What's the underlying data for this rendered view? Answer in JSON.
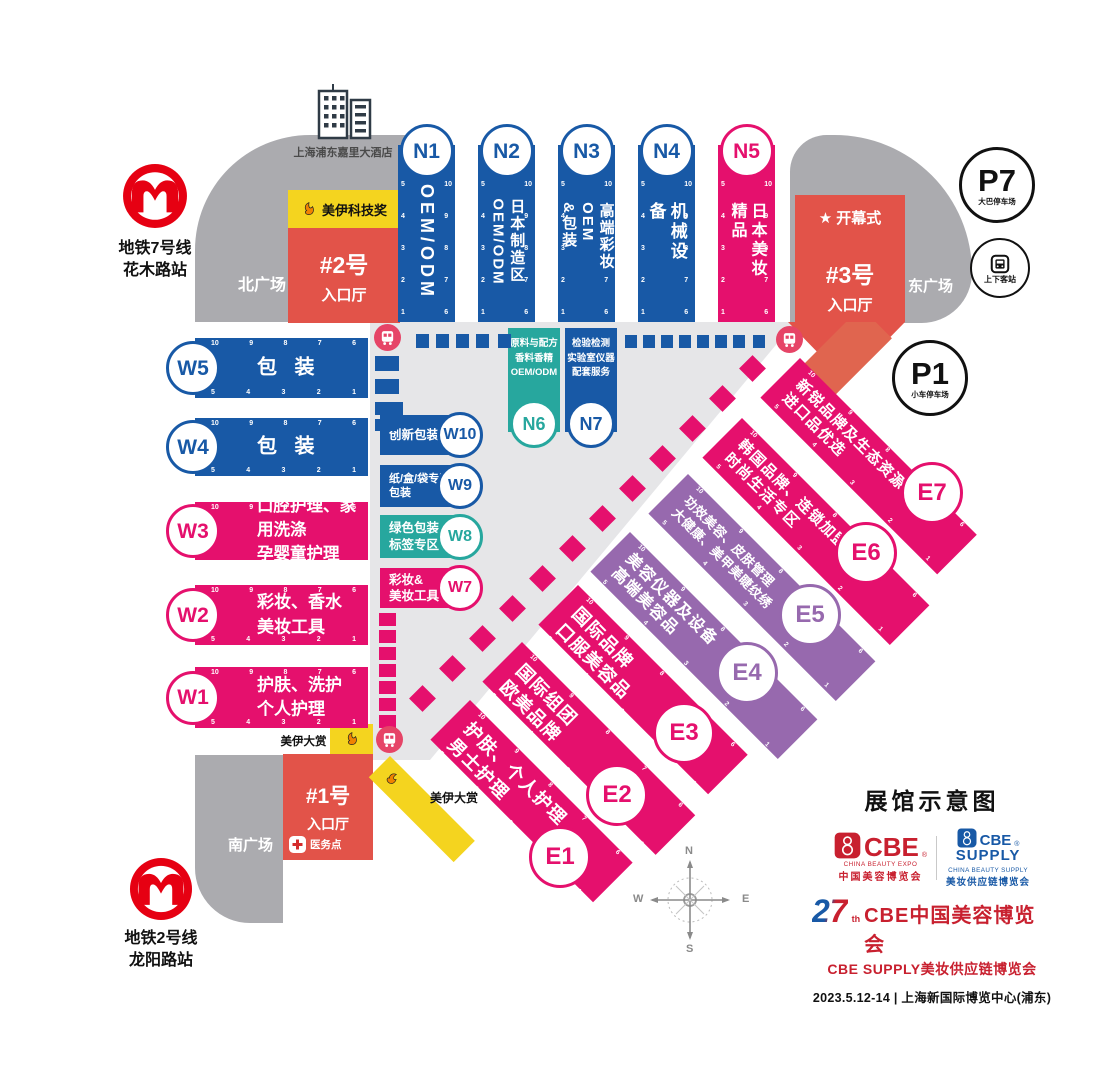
{
  "map": {
    "title": "展馆示意图"
  },
  "landmarks": {
    "hotel": "上海浦东嘉里大酒店",
    "metro_line7": {
      "line": "地铁7号线",
      "station": "花木路站"
    },
    "metro_line2": {
      "line": "地铁2号线",
      "station": "龙阳路站"
    }
  },
  "plazas": {
    "north": "北广场",
    "east": "东广场",
    "south": "南广场"
  },
  "entrances": {
    "e1": {
      "id": "#1号",
      "hall": "入口厅"
    },
    "e2": {
      "id": "#2号",
      "hall": "入口厅",
      "banner": "美伊科技奖"
    },
    "e3": {
      "id": "#3号",
      "hall": "入口厅",
      "event": "开幕式",
      "star": "★"
    }
  },
  "award": {
    "label": "美伊大赏"
  },
  "medical": {
    "label": "医务点"
  },
  "transport": {
    "p7": {
      "id": "P7",
      "label": "大巴停车场"
    },
    "p1": {
      "id": "P1",
      "label": "小车停车场"
    },
    "passenger": {
      "label": "上下客站"
    }
  },
  "gates": {
    "near": [
      "5",
      "4",
      "3",
      "2",
      "1"
    ],
    "far": [
      "10",
      "9",
      "8",
      "7",
      "6"
    ]
  },
  "halls": {
    "north": [
      {
        "id": "N1",
        "label": "OEM/ODM"
      },
      {
        "id": "N2",
        "label": "日本制造区\nOEM/ODM"
      },
      {
        "id": "N3",
        "label": "高端彩妆OEM\n&包装"
      },
      {
        "id": "N4",
        "label": "机械设备"
      },
      {
        "id": "N5",
        "label": "日本美妆精品"
      }
    ],
    "inner": [
      {
        "id": "N6",
        "label": "原料与配方\n香料香精\nOEM/ODM"
      },
      {
        "id": "N7",
        "label": "检验检测\n实验室仪器\n配套服务"
      }
    ],
    "west": [
      {
        "id": "W5",
        "label": "包 装"
      },
      {
        "id": "W4",
        "label": "包 装"
      },
      {
        "id": "W3",
        "label": "口腔护理、家用洗涤\n孕婴童护理"
      },
      {
        "id": "W2",
        "label": "彩妆、香水\n美妆工具"
      },
      {
        "id": "W1",
        "label": "护肤、洗护\n个人护理"
      }
    ],
    "west_special": [
      {
        "id": "W10",
        "label": "创新包装"
      },
      {
        "id": "W9",
        "label": "纸/盒/袋专区\n包装"
      },
      {
        "id": "W8",
        "label": "绿色包装\n标签专区"
      },
      {
        "id": "W7",
        "label": "彩妆&\n美妆工具"
      }
    ],
    "east": [
      {
        "id": "E1",
        "label": "护肤、个人护理\n男士护理"
      },
      {
        "id": "E2",
        "label": "国际组团\n欧美品牌"
      },
      {
        "id": "E3",
        "label": "国际品牌\n口服美容品"
      },
      {
        "id": "E4",
        "label": "美容仪器及设备\n高端美容品"
      },
      {
        "id": "E5",
        "label": "功效美容、皮肤管理\n大健康、美甲美睫纹绣"
      },
      {
        "id": "E6",
        "label": "韩国品牌、连锁加盟\n时尚生活专区"
      },
      {
        "id": "E7",
        "label": "新锐品牌及生态资源\n进口品优选"
      }
    ]
  },
  "compass": {
    "n": "N",
    "e": "E",
    "s": "S",
    "w": "W"
  },
  "footer": {
    "cbe": {
      "name": "CBE",
      "sub1": "CHINA BEAUTY EXPO",
      "sub2": "中国美容博览会",
      "reg": "®"
    },
    "supply": {
      "name1": "CBE",
      "name2": "SUPPLY",
      "sub1": "CHINA BEAUTY SUPPLY",
      "sub2": "美妆供应链博览会",
      "reg": "®"
    },
    "edition": "27",
    "edition_sup": "th",
    "line1": "CBE中国美容博览会",
    "line2": "CBE SUPPLY美妆供应链博览会",
    "date_venue": "2023.5.12-14 | 上海新国际博览中心(浦东)"
  },
  "colors": {
    "blue": "#1859a6",
    "pink": "#e5106d",
    "purple": "#9769ae",
    "teal": "#27a79e",
    "entrance_red": "#e25349",
    "yellow": "#f4d41f",
    "plaza_gray": "#ababaf",
    "corridor_gray": "#e6e6e8",
    "metro_red": "#e60012",
    "cbe_red": "#c8202f"
  }
}
